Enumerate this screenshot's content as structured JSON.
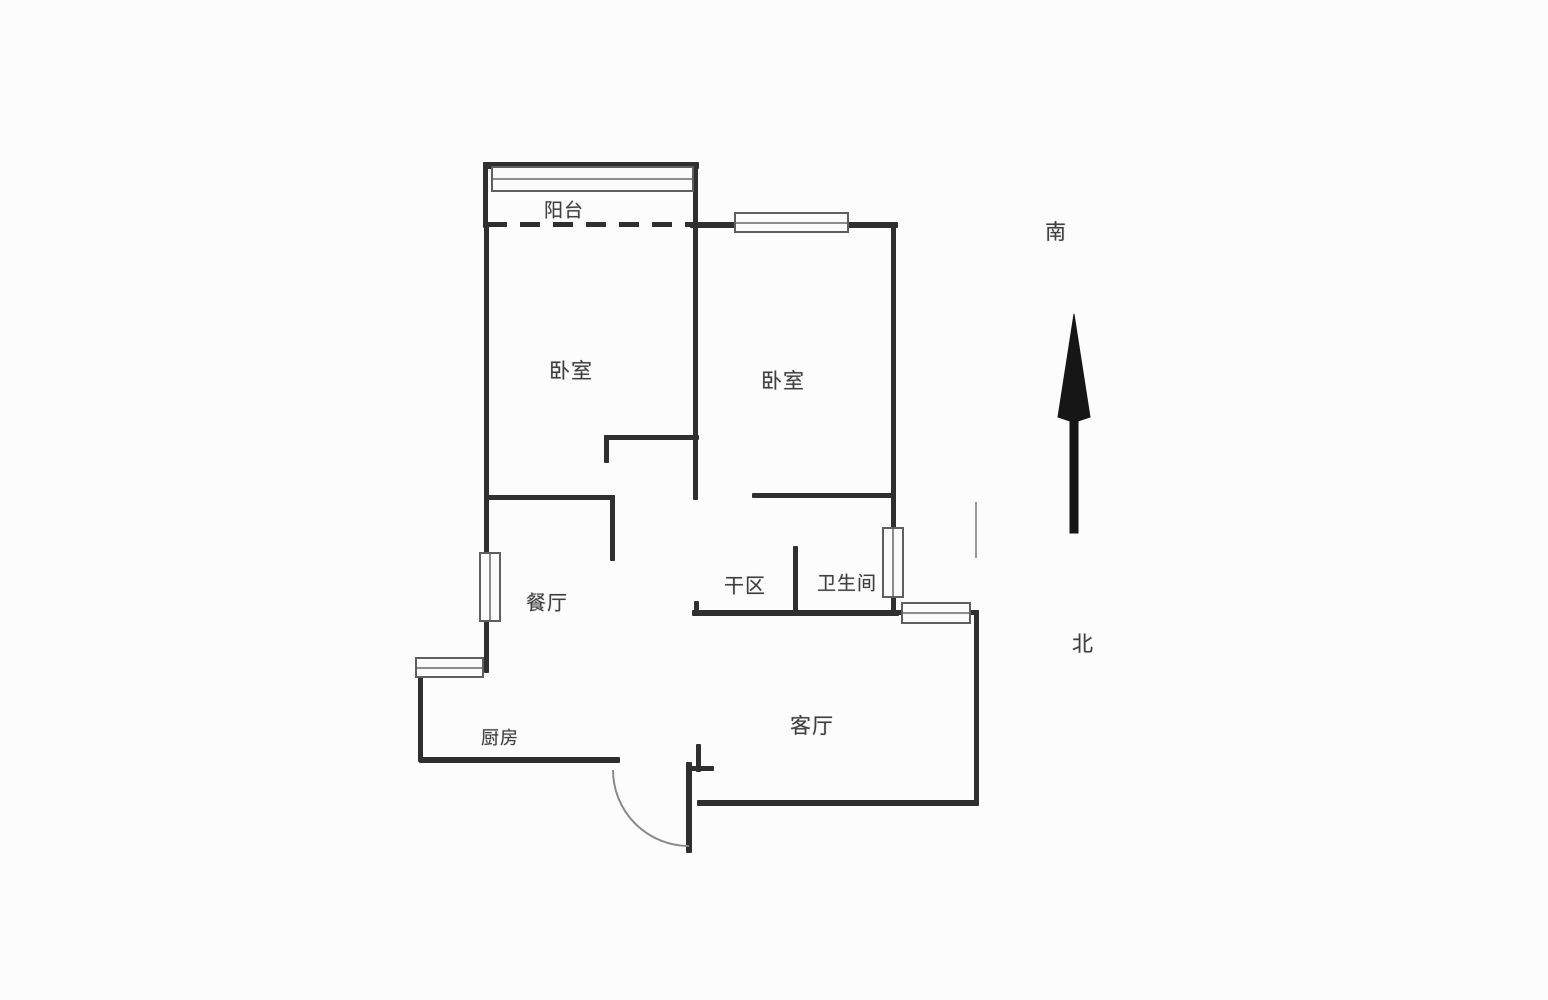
{
  "page": {
    "background": "#fcfcfc"
  },
  "plan": {
    "colors": {
      "wall": "#2f2f2f",
      "window_border": "#5f5f5f",
      "window_fill": "#fbfbfb",
      "window_mid": "#8c8c8c",
      "door_arc": "#8a8a8a",
      "label_text": "#3f3f3f",
      "compass_arrow": "#161616",
      "faint_opening": "#9a9a9a"
    },
    "labels": [
      {
        "name": "balcony",
        "text": "阳台",
        "x": 564,
        "y": 209,
        "fs": 19
      },
      {
        "name": "bedroom-left",
        "text": "卧室",
        "x": 571,
        "y": 370,
        "fs": 21
      },
      {
        "name": "bedroom-right",
        "text": "卧室",
        "x": 783,
        "y": 380,
        "fs": 21
      },
      {
        "name": "dining-room",
        "text": "餐厅",
        "x": 547,
        "y": 601,
        "fs": 20
      },
      {
        "name": "dry-area",
        "text": "干区",
        "x": 745,
        "y": 584,
        "fs": 20
      },
      {
        "name": "bathroom",
        "text": "卫生间",
        "x": 847,
        "y": 582,
        "fs": 19
      },
      {
        "name": "kitchen",
        "text": "厨房",
        "x": 500,
        "y": 737,
        "fs": 18
      },
      {
        "name": "living-room",
        "text": "客厅",
        "x": 812,
        "y": 725,
        "fs": 21
      },
      {
        "name": "compass-south",
        "text": "南",
        "x": 1056,
        "y": 231,
        "fs": 21
      },
      {
        "name": "compass-north",
        "text": "北",
        "x": 1083,
        "y": 643,
        "fs": 21
      }
    ],
    "walls": [
      {
        "name": "balcony-top-wall",
        "x": 483,
        "y": 162,
        "w": 216,
        "h": 7
      },
      {
        "name": "balcony-left-wall",
        "x": 483,
        "y": 162,
        "w": 5,
        "h": 66
      },
      {
        "name": "bedroom-divider-wall",
        "x": 693,
        "y": 162,
        "w": 5,
        "h": 338
      },
      {
        "name": "bedroom-right-top-wall",
        "x": 690,
        "y": 222,
        "w": 208,
        "h": 6
      },
      {
        "name": "bathroom-right-wall",
        "x": 891,
        "y": 222,
        "w": 5,
        "h": 391
      },
      {
        "name": "west-exterior-wall",
        "x": 484,
        "y": 224,
        "w": 5,
        "h": 449
      },
      {
        "name": "dining-top-wall",
        "x": 484,
        "y": 495,
        "w": 131,
        "h": 5
      },
      {
        "name": "dining-door-jamb",
        "x": 610,
        "y": 495,
        "w": 5,
        "h": 66
      },
      {
        "name": "bedroom-notch-wall",
        "x": 604,
        "y": 435,
        "w": 95,
        "h": 5
      },
      {
        "name": "bedroom-notch-jamb",
        "x": 604,
        "y": 435,
        "w": 5,
        "h": 28
      },
      {
        "name": "bedroom-right-bottom-wall",
        "x": 752,
        "y": 493,
        "w": 144,
        "h": 5
      },
      {
        "name": "wet-area-divider-wall",
        "x": 793,
        "y": 546,
        "w": 5,
        "h": 70
      },
      {
        "name": "dry-area-bottom-wall",
        "x": 692,
        "y": 610,
        "w": 207,
        "h": 6
      },
      {
        "name": "dry-area-wall-tick",
        "x": 694,
        "y": 601,
        "w": 5,
        "h": 11
      },
      {
        "name": "living-top-wall",
        "x": 896,
        "y": 610,
        "w": 83,
        "h": 5
      },
      {
        "name": "living-right-wall",
        "x": 974,
        "y": 610,
        "w": 5,
        "h": 195
      },
      {
        "name": "living-bottom-wall",
        "x": 697,
        "y": 800,
        "w": 282,
        "h": 6
      },
      {
        "name": "entry-door-leaf",
        "x": 686,
        "y": 762,
        "w": 6,
        "h": 91
      },
      {
        "name": "entry-jamb-vertical",
        "x": 696,
        "y": 744,
        "w": 5,
        "h": 28
      },
      {
        "name": "entry-jamb-horizontal",
        "x": 686,
        "y": 766,
        "w": 28,
        "h": 5
      },
      {
        "name": "kitchen-bottom-wall",
        "x": 419,
        "y": 757,
        "w": 201,
        "h": 6
      },
      {
        "name": "kitchen-left-wall",
        "x": 418,
        "y": 674,
        "w": 5,
        "h": 88
      }
    ],
    "dashed_wall": {
      "name": "balcony-boundary-dashed",
      "x": 487,
      "y": 222,
      "w": 205,
      "h": 5
    },
    "faint_opening_line": {
      "name": "hall-opening-line",
      "x": 975,
      "y": 502,
      "w": 2,
      "h": 56
    },
    "windows": [
      {
        "name": "balcony-window",
        "x": 491,
        "y": 166,
        "w": 203,
        "h": 26,
        "orient": "h"
      },
      {
        "name": "bedroom-right-window",
        "x": 734,
        "y": 212,
        "w": 115,
        "h": 21,
        "orient": "h"
      },
      {
        "name": "dining-window",
        "x": 479,
        "y": 552,
        "w": 22,
        "h": 70,
        "orient": "v"
      },
      {
        "name": "kitchen-window",
        "x": 415,
        "y": 657,
        "w": 69,
        "h": 21,
        "orient": "h"
      },
      {
        "name": "bathroom-window",
        "x": 882,
        "y": 527,
        "w": 22,
        "h": 71,
        "orient": "v"
      },
      {
        "name": "living-window",
        "x": 901,
        "y": 602,
        "w": 70,
        "h": 22,
        "orient": "h"
      }
    ],
    "entry_door": {
      "arc_path": "M 613 770 A 76 76 0 0 0 689 846"
    },
    "compass": {
      "south_label": "南",
      "north_label": "北",
      "arrow_path": "M 1074 314 L 1090 417 L 1078 421 L 1078 533 L 1070 533 L 1070 421 L 1058 417 Z"
    }
  }
}
